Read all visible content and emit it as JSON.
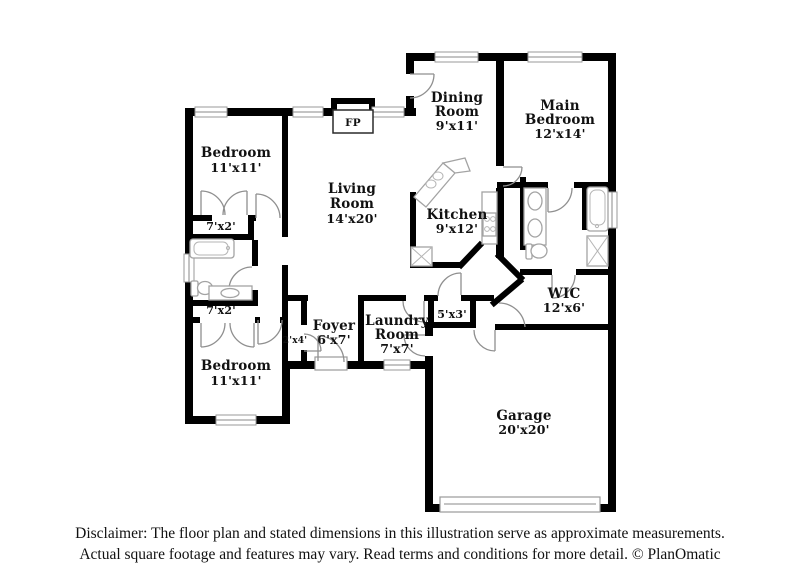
{
  "floor_plan": {
    "rooms": {
      "bedroom_top": {
        "name": "Bedroom",
        "dims": "11'x11'"
      },
      "closet_top": {
        "dims": "7'x2'"
      },
      "closet_mid": {
        "dims": "7'x2'"
      },
      "bedroom_bottom": {
        "name": "Bedroom",
        "dims": "11'x11'"
      },
      "living": {
        "name1": "Living",
        "name2": "Room",
        "dims": "14'x20'"
      },
      "dining": {
        "name1": "Dining",
        "name2": "Room",
        "dims": "9'x11'"
      },
      "main_bedroom": {
        "name1": "Main",
        "name2": "Bedroom",
        "dims": "12'x14'"
      },
      "kitchen": {
        "name": "Kitchen",
        "dims": "9'x12'"
      },
      "wic": {
        "name": "WIC",
        "dims": "12'x6'"
      },
      "hall_closet": {
        "dims": "5'x3'"
      },
      "foyer": {
        "name": "Foyer",
        "dims": "6'x7'"
      },
      "foyer_closet": {
        "dims": "2'x4'"
      },
      "laundry": {
        "name1": "Laundry",
        "name2": "Room",
        "dims": "7'x7'"
      },
      "garage": {
        "name": "Garage",
        "dims": "20'x20'"
      }
    },
    "fireplace_label": "FP",
    "disclaimer": {
      "line1": "Disclaimer: The floor plan and stated dimensions in this illustration serve as approximate measurements.",
      "line2": "Actual square footage and features may vary. Read terms and conditions for more detail. © PlanOmatic"
    },
    "colors": {
      "wall": "#000000",
      "background": "#ffffff",
      "fixture_outline": "#a3a3a3",
      "text": "#111111"
    }
  }
}
